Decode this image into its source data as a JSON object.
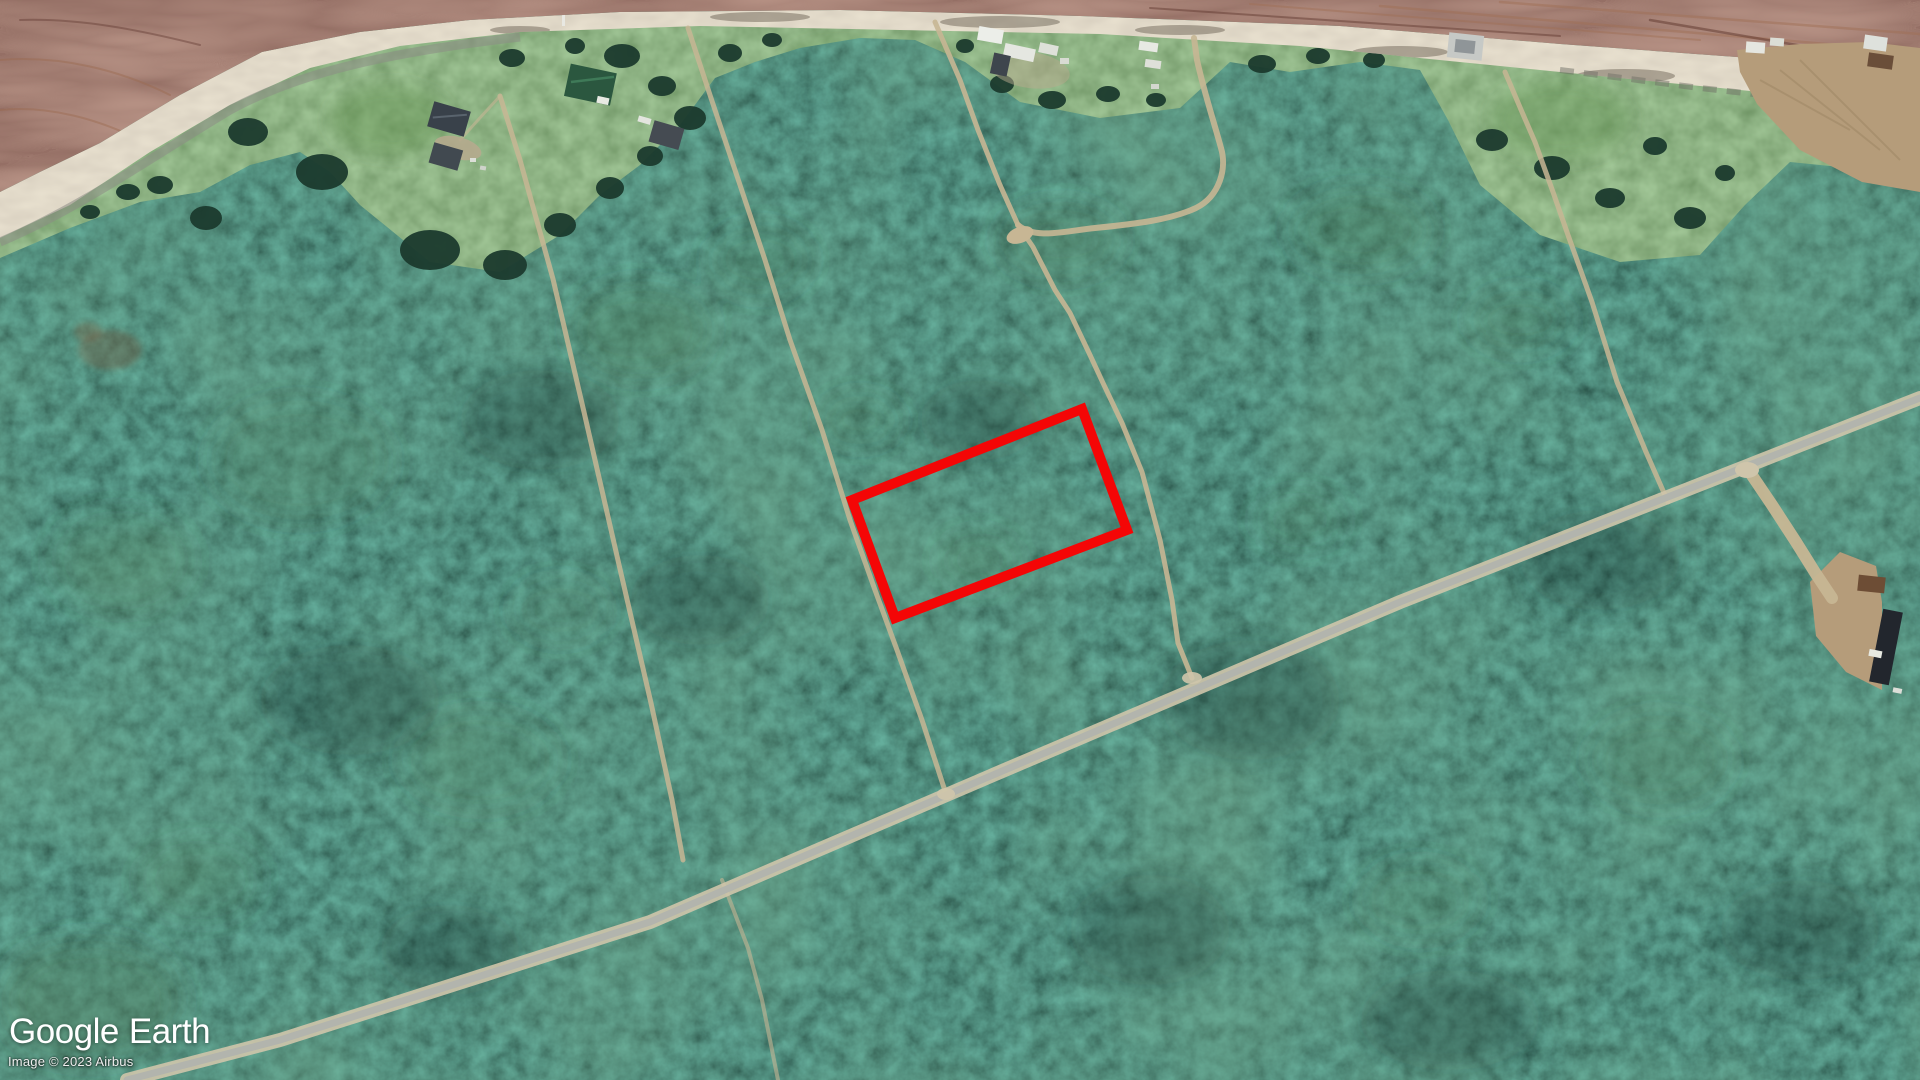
{
  "branding": {
    "logo_primary": "Google",
    "logo_secondary": "Earth"
  },
  "attribution": {
    "text": "Image © 2023 Airbus"
  },
  "overlay": {
    "points": "852,500 1082,409 1127,530 895,618",
    "color": "#f40606",
    "stroke_width": 10
  },
  "palette": {
    "forest-base": "#16342a",
    "grass": "#4c7a45",
    "beach": "#c3b194",
    "water": "#744539",
    "road-asphalt": "#b2b4ad",
    "road-shoulder": "#cfc5ab",
    "trail": "#c7b694",
    "dirt": "#b59c7a",
    "overlay-red": "#f40606"
  }
}
